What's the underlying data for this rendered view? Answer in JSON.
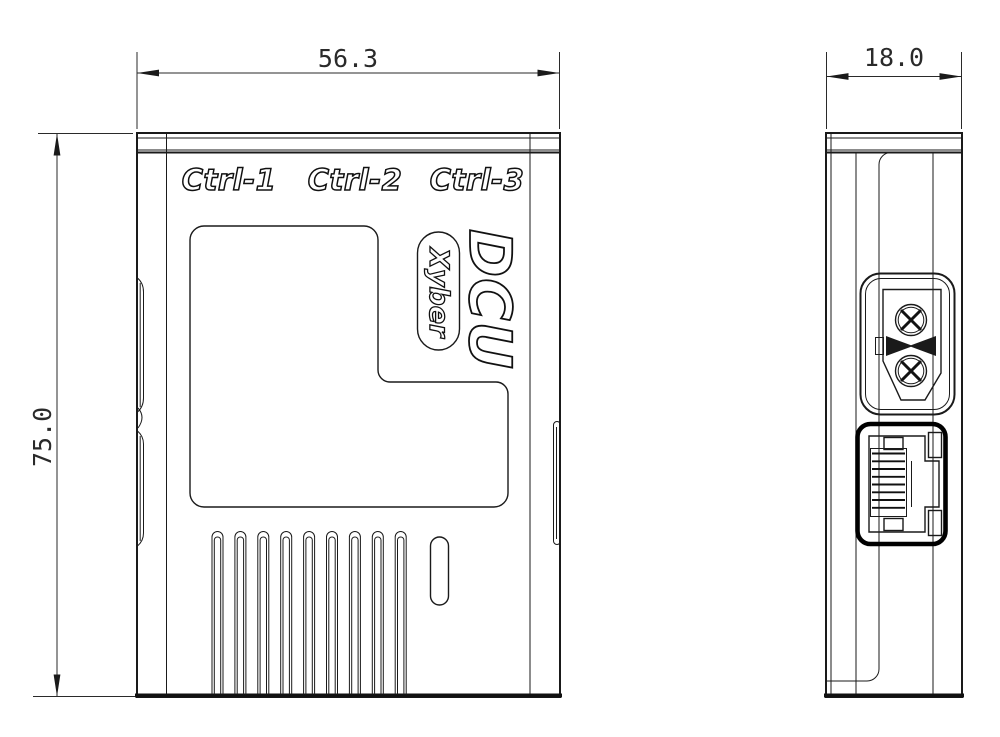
{
  "views": {
    "front": {
      "width_dim": "56.3",
      "height_dim": "75.0",
      "port_labels": [
        "Ctrl-1",
        "Ctrl-2",
        "Ctrl-3"
      ],
      "product_name": "DCU",
      "brand": "Xyber"
    },
    "side": {
      "depth_dim": "18.0"
    }
  },
  "colors": {
    "line": "#1a1a1a",
    "background": "#ffffff"
  }
}
